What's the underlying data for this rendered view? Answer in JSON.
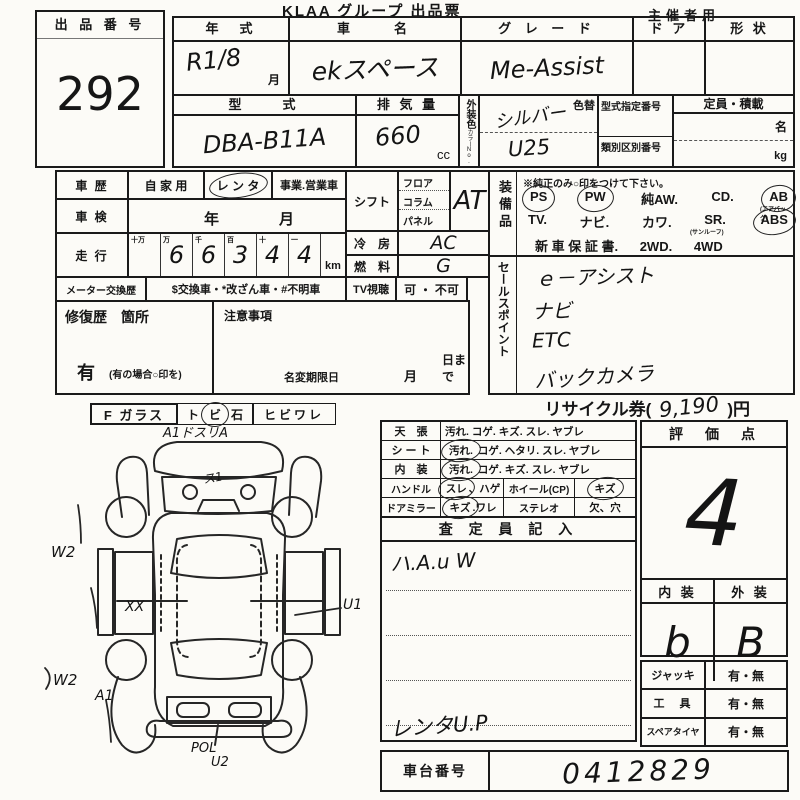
{
  "header": {
    "title": "KLAA グループ 出品票",
    "audience": "主催者用"
  },
  "lot": {
    "label": "出 品 番 号",
    "number": "292"
  },
  "spec": {
    "year": {
      "label": "年　式",
      "value": "R1/8",
      "suffix": "月"
    },
    "name": {
      "label": "車　　名",
      "value": "ekスペース"
    },
    "grade": {
      "label": "グ レ ー ド",
      "value": "Me-Assist"
    },
    "door": {
      "label": "ド ア"
    },
    "shape": {
      "label": "形 状"
    },
    "model": {
      "label": "型　　式",
      "value": "DBA-B11A"
    },
    "displacement": {
      "label": "排 気 量",
      "value": "660",
      "unit": "cc"
    },
    "color": {
      "label": "外装色",
      "no_label": "カラーNo.",
      "value": "シルバー",
      "no_value": "U25",
      "change_label": "色替"
    },
    "codes": {
      "model_code_label": "型式指定番号",
      "class_code_label": "類別区別番号"
    },
    "capacity": {
      "label": "定員・積載",
      "unit_persons": "名",
      "unit_kg": "kg"
    }
  },
  "history": {
    "label": "車 歴",
    "opt_private": "自 家 用",
    "opt_rental": "レ ン タ",
    "opt_business": "事業.営業車"
  },
  "inspection": {
    "label": "車 検",
    "year": "年",
    "month": "月"
  },
  "mileage": {
    "label": "走 行",
    "headers": [
      "十万",
      "万",
      "千",
      "百",
      "十",
      "一"
    ],
    "digits": [
      "",
      "6",
      "6",
      "3",
      "4",
      "4"
    ],
    "unit": "km"
  },
  "meter": {
    "label": "メーター交換歴",
    "value": "$交換車・*改ざん車・#不明車"
  },
  "tv": {
    "label": "TV視聴",
    "value": "可 ・ 不可"
  },
  "shift": {
    "label": "シフト",
    "opt1": "フロア",
    "opt2": "コラム",
    "opt3": "パネル",
    "value": "AT"
  },
  "ac": {
    "label": "冷　房",
    "value": "AC"
  },
  "fuel": {
    "label": "燃　料",
    "value": "G"
  },
  "equipment": {
    "label": "装備品",
    "note": "※純正のみ○印をつけて下さい。",
    "ps": "PS",
    "pw": "PW",
    "aw": "純AW.",
    "cd": "CD.",
    "ab": "AB",
    "ab_note": "(エアバッグ)",
    "tv": "TV.",
    "navi": "ナビ.",
    "leather": "カワ.",
    "sr": "SR.",
    "sr_note": "(サンルーフ)",
    "abs": "ABS",
    "warranty": "新 車 保 証 書.",
    "wd2": "2WD.",
    "wd4": "4WD"
  },
  "sales": {
    "label": "セールスポイント",
    "items": [
      "ｅ－アシスト",
      "ナビ",
      "ETC",
      "バックカメラ"
    ]
  },
  "repair": {
    "label": "修復歴　箇所",
    "has": "有",
    "has_note": "(有の場合○印を)"
  },
  "notes": {
    "label": "注意事項",
    "deadline": "名変期限日",
    "month": "月",
    "day": "日まで"
  },
  "recycle": {
    "label": "リサイクル券(",
    "amount": "9,190",
    "suffix": ")円"
  },
  "glass": {
    "label": "F ガラス",
    "opt1": "ト",
    "opt2": "ビ",
    "opt3": "石",
    "opt4": "ヒビワレ"
  },
  "condition": {
    "rows3": [
      {
        "label": "天　張",
        "first": "汚れ.",
        "rest": "コゲ. キズ. スレ. ヤブレ"
      },
      {
        "label": "シ ー ト",
        "first": "汚れ.",
        "rest": "コゲ. ヘタリ. スレ. ヤブレ"
      },
      {
        "label": "内　装",
        "first": "汚れ.",
        "rest": "コゲ. キズ. スレ. ヤブレ"
      }
    ],
    "rows2": [
      {
        "label": "ハンドル",
        "first": "スレ",
        "rest": "、ハゲ",
        "mid": "ホイール(CP)",
        "right": "キズ"
      },
      {
        "label": "ドアミラー",
        "first": "キズ",
        "rest": ".ワレ",
        "mid": "ステレオ",
        "right": "欠、穴"
      }
    ]
  },
  "inspector": {
    "header": "査 定 員 記 入",
    "note": "ハ.A.u W",
    "bottom_note": "レンタU.P"
  },
  "score": {
    "header": "評　価　点",
    "value": "4",
    "interior_label": "内 装",
    "exterior_label": "外 装",
    "interior_value": "b",
    "exterior_value": "B"
  },
  "accessories": [
    {
      "label": "ジャッキ",
      "value": "有・無"
    },
    {
      "label": "工　具",
      "value": "有・無"
    },
    {
      "label": "スペアタイヤ",
      "value": "有・無"
    }
  ],
  "chassis": {
    "label": "車台番号",
    "value": "0412829"
  },
  "diagram": {
    "top_note": "A1ドスリA",
    "s1": "ス1",
    "w2_top": "W2",
    "w2_bottom": "W2",
    "a1": "A1",
    "xx": "XX",
    "u1": "U1",
    "pol": "POL",
    "u2": "U2"
  }
}
